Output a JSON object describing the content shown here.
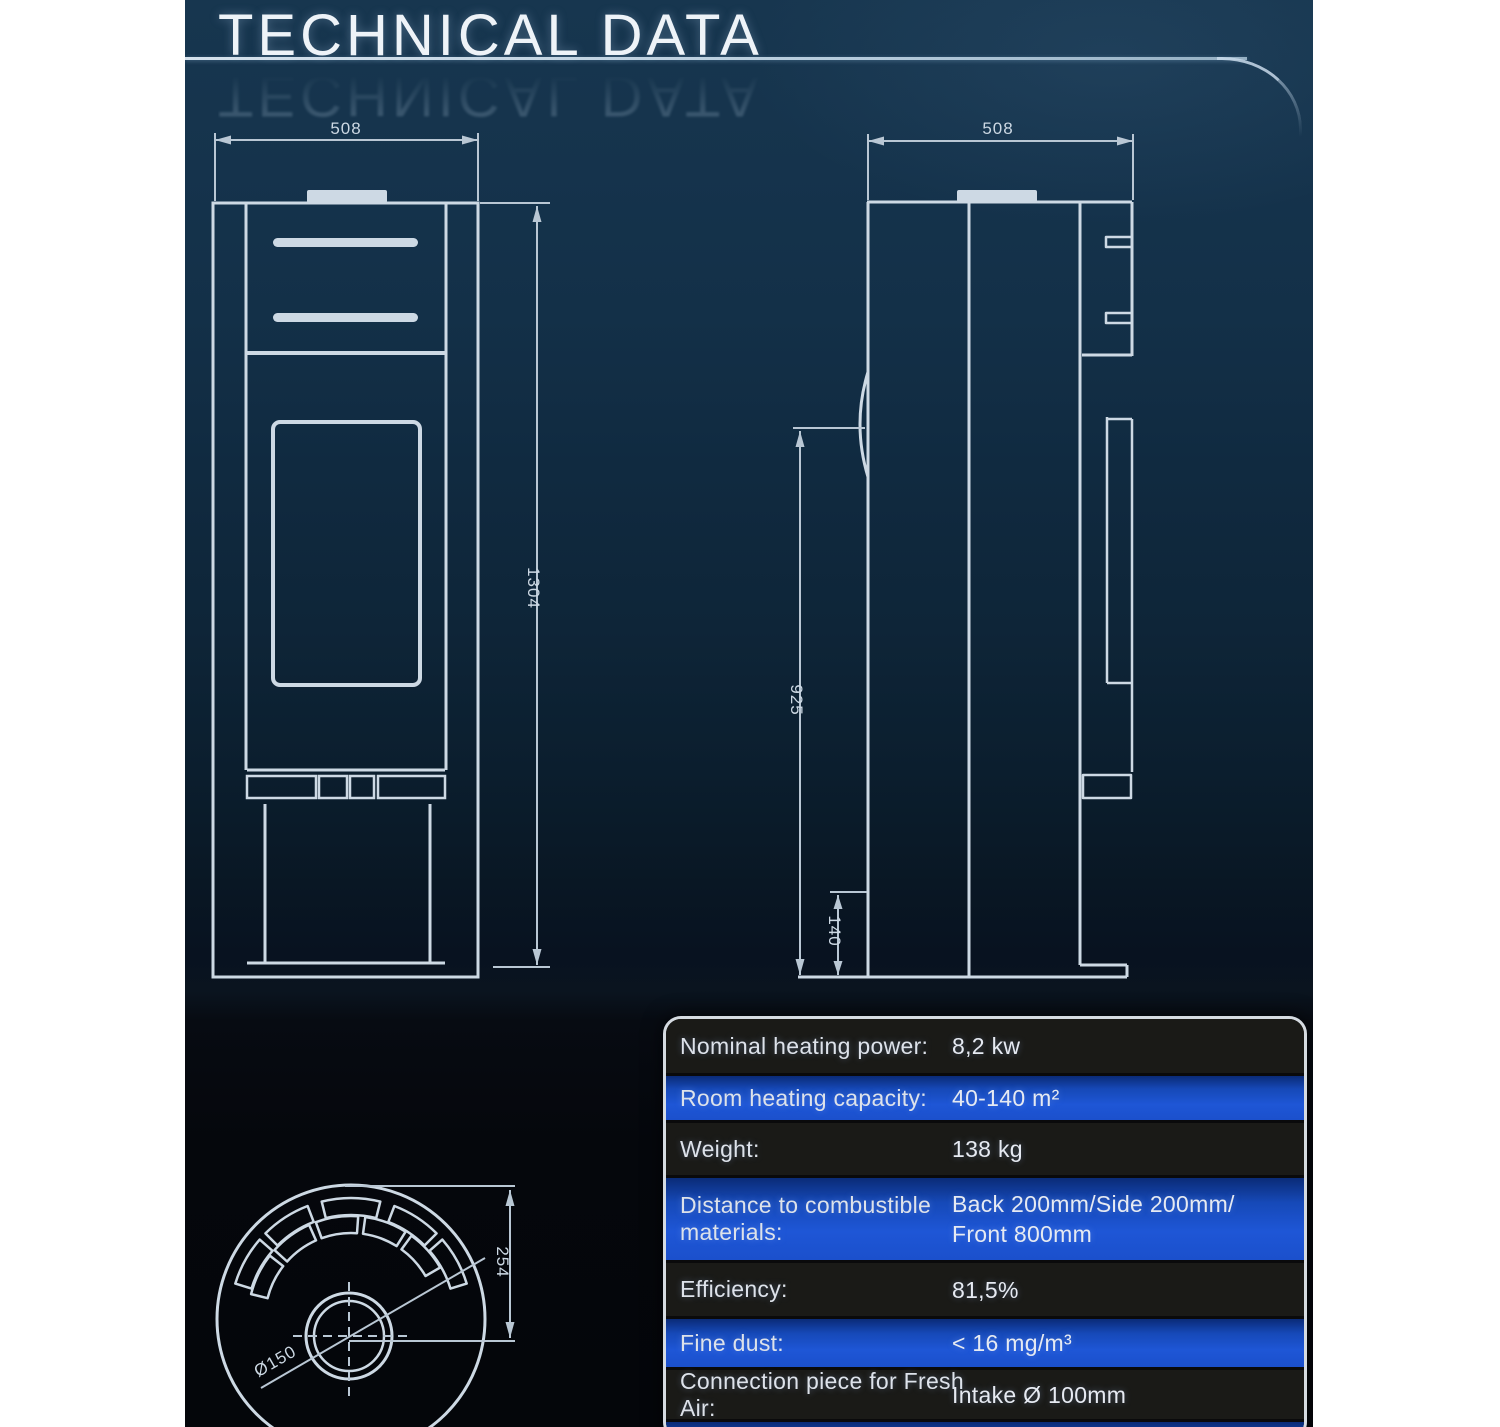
{
  "title": "TECHNICAL DATA",
  "colors": {
    "page_margin": "#ffffff",
    "bg_top": "#17364f",
    "bg_bottom": "#04060a",
    "line": "#cdd9e4",
    "dim_line": "#b9c7d4",
    "accent_blue": "#1d55d4",
    "row_dark": "#1a1a17",
    "table_border": "#d5dbe1",
    "text_light": "#dde2ea"
  },
  "drawings": {
    "front_view": {
      "width_dim": "508",
      "height_dim": "1304"
    },
    "side_view": {
      "depth_dim": "508",
      "door_height_dim": "925",
      "base_height_dim": "140"
    },
    "top_view": {
      "flue_offset_dim": "254",
      "flue_diameter_dim": "Ø150"
    }
  },
  "table": {
    "rows": [
      {
        "label": "Nominal heating power:",
        "value": "8,2 kw",
        "highlight": false
      },
      {
        "label": "Room heating capacity:",
        "value": "40-140 m²",
        "highlight": true
      },
      {
        "label": "Weight:",
        "value": "138 kg",
        "highlight": false
      },
      {
        "label": "Distance to combustible materials:",
        "value": "Back 200mm/Side 200mm/",
        "value2": "Front 800mm",
        "highlight": true
      },
      {
        "label": "Efficiency:",
        "value": "81,5%",
        "highlight": false
      },
      {
        "label": "Fine dust:",
        "value": "< 16 mg/m³",
        "highlight": true
      },
      {
        "label": "Connection piece for Fresh Air:",
        "value": "Intake Ø 100mm",
        "highlight": false
      },
      {
        "label": "",
        "value": "",
        "highlight": true
      }
    ]
  }
}
